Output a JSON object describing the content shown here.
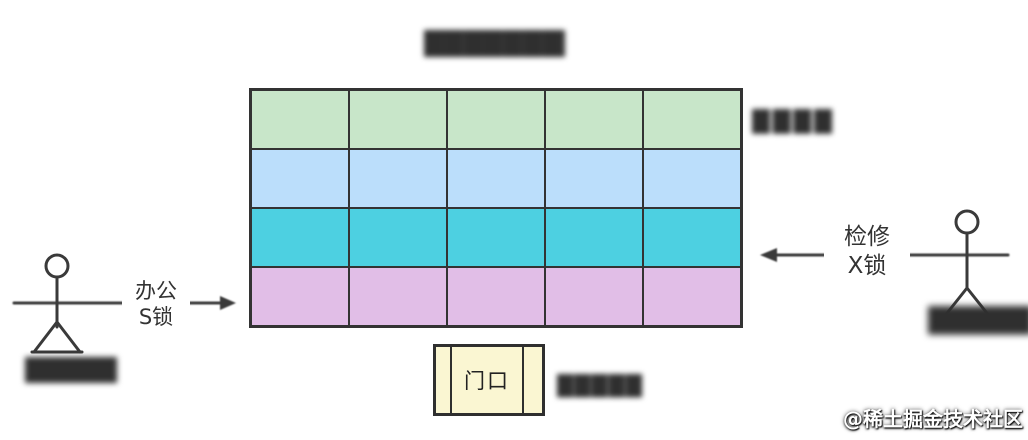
{
  "title": {
    "blurred_text": "████████"
  },
  "grid": {
    "rows": 4,
    "cols": 5,
    "row_colors": [
      "#c8e6c9",
      "#bbdefb",
      "#4dd0e1",
      "#e1bee7"
    ],
    "line_color": "#333333",
    "side_label_blurred": "████"
  },
  "left_actor": {
    "name_blurred": "█████",
    "lock_label": {
      "line1": "办公",
      "line2": "S锁"
    }
  },
  "right_actor": {
    "name_blurred": "█████",
    "lock_label": {
      "line1": "检修",
      "line2": "X锁"
    }
  },
  "entrance": {
    "label": "门口",
    "fill_color": "#faf6d2",
    "note_blurred": "█████"
  },
  "watermark": {
    "text": "@稀土掘金技术社区"
  }
}
